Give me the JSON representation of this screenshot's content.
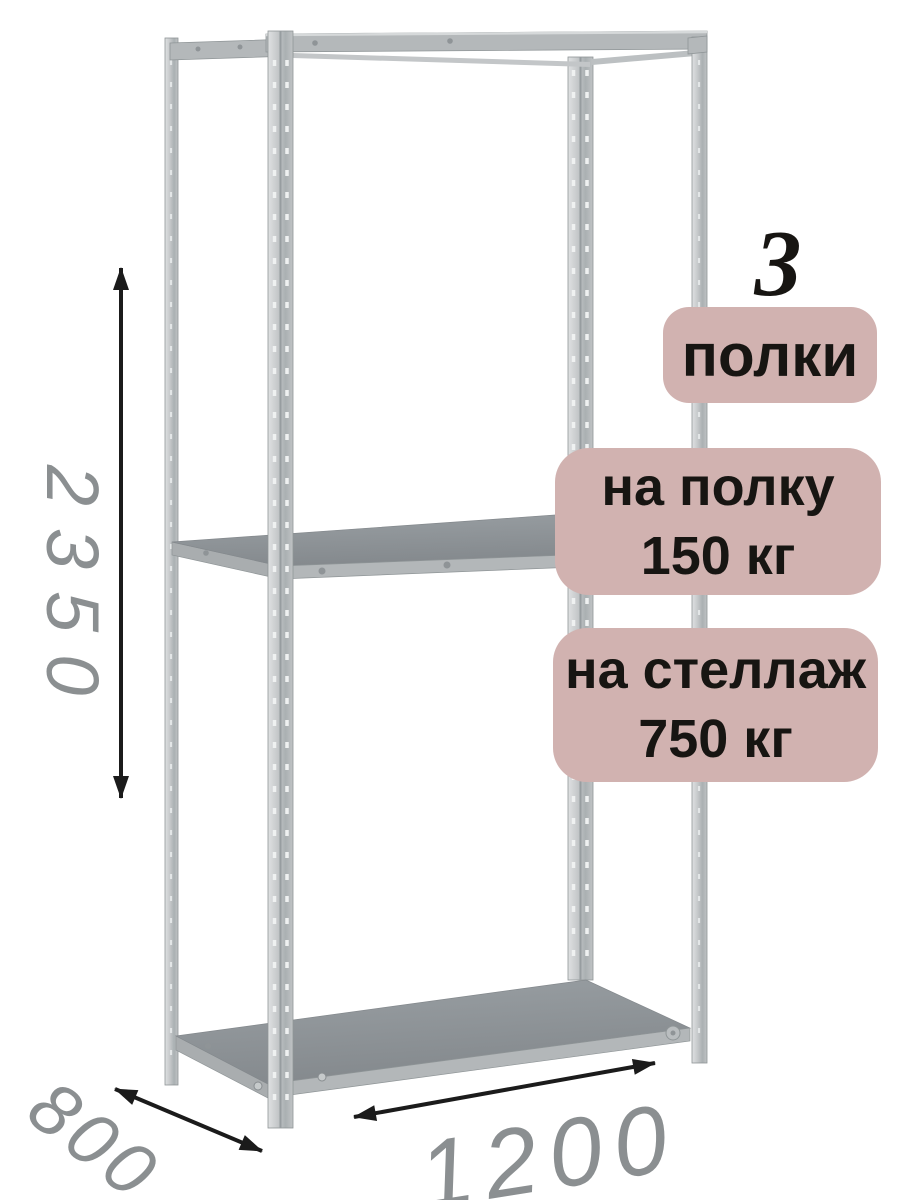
{
  "badges": {
    "count": {
      "value": "3",
      "label": "полки"
    },
    "shelf_load": {
      "line1": "на полку",
      "line2": "150 кг"
    },
    "rack_load": {
      "line1": "на стеллаж",
      "line2": "750 кг"
    }
  },
  "dimensions": {
    "height_mm": "2350",
    "depth_mm": "800",
    "width_mm": "1200"
  },
  "colors": {
    "badge_bg": "#d1b2b0",
    "badge_text": "#171512",
    "dimension_text": "#8b8f91",
    "arrow": "#1b1b1b",
    "background": "#ffffff"
  }
}
